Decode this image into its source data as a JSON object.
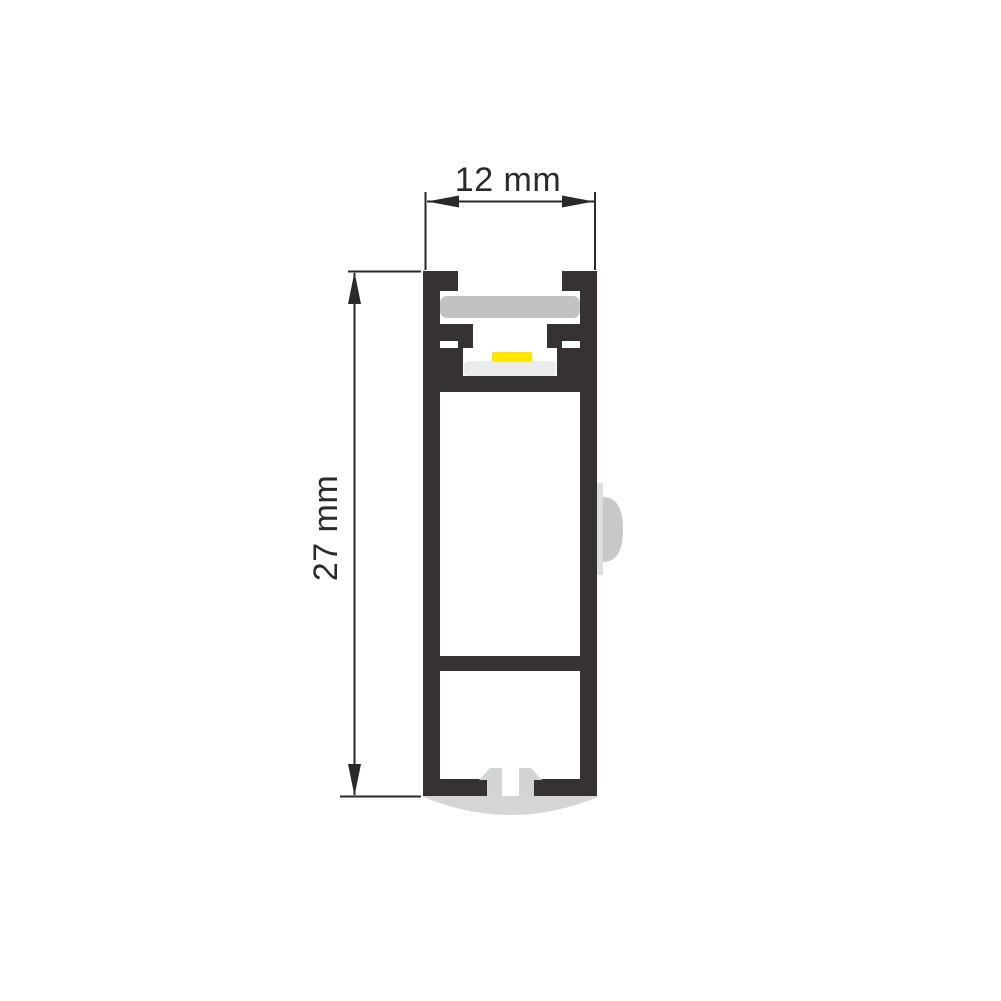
{
  "diagram": {
    "type": "technical-cross-section",
    "subject": "led-aluminium-profile",
    "dimensions": {
      "width_label": "12 mm",
      "height_label": "27 mm"
    },
    "colors": {
      "background": "#ffffff",
      "profile_body": "#363133",
      "dimension_ink": "#2b292a",
      "diffuser": "#c0c2c4",
      "led_strip": "#ffe500",
      "pcb": "#e9ebec",
      "mount_clip": "#d2d4d6",
      "base_plate": "#d3d5d6",
      "side_strip": "#dddee0",
      "side_bump": "#c6c8ca"
    }
  }
}
